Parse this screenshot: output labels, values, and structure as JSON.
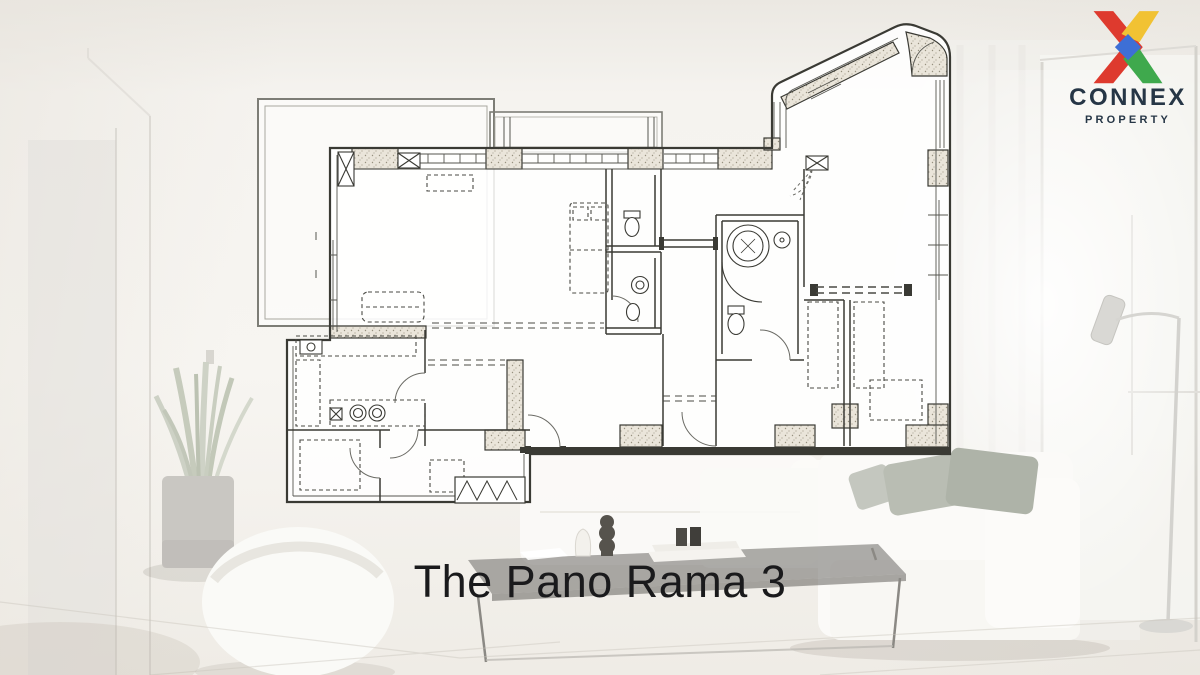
{
  "logo": {
    "brand": "CONNEX",
    "tagline": "PROPERTY",
    "text_color": "#263646",
    "x_colors": {
      "red": "#de3a2e",
      "yellow": "#f1c233",
      "green": "#3fa94d",
      "blue": "#3d6fd6"
    }
  },
  "caption": {
    "title": "The Pano Rama 3",
    "color": "#1a1a1c"
  },
  "floor_plan": {
    "kind": "architectural floor plan, no text labels visible",
    "ink": "#3a3a34",
    "paper": "rgba(255,255,255,0.85)",
    "features": [
      "wrap-around terrace outline top-left",
      "narrow balcony strip top-center",
      "angled bay wing with rounded corner top-right",
      "hatched structural wall piers",
      "living-dining area with dashed furniture outlines",
      "kitchen with double stove burners",
      "two bathrooms with toilets, basins and a round jacuzzi",
      "bedrooms with dashed wardrobes",
      "door swing arcs and dashed overhang guide lines"
    ]
  },
  "background": {
    "scene": "faded white living-room photograph",
    "elements": [
      "white wall with door frame (left)",
      "potted snake plant",
      "round white armchair (bottom-left)",
      "dark glass coffee table with vase, sculpture and books",
      "white sofas with grey cushions (right)",
      "floor lamp and window with sheer curtains (right)"
    ],
    "palette": {
      "wall": "#f4f2ee",
      "floor": "#efede8",
      "table_top": "rgba(70,70,68,0.55)",
      "cushion_grey": "#b3b8ae",
      "shadow": "#948e82"
    }
  }
}
